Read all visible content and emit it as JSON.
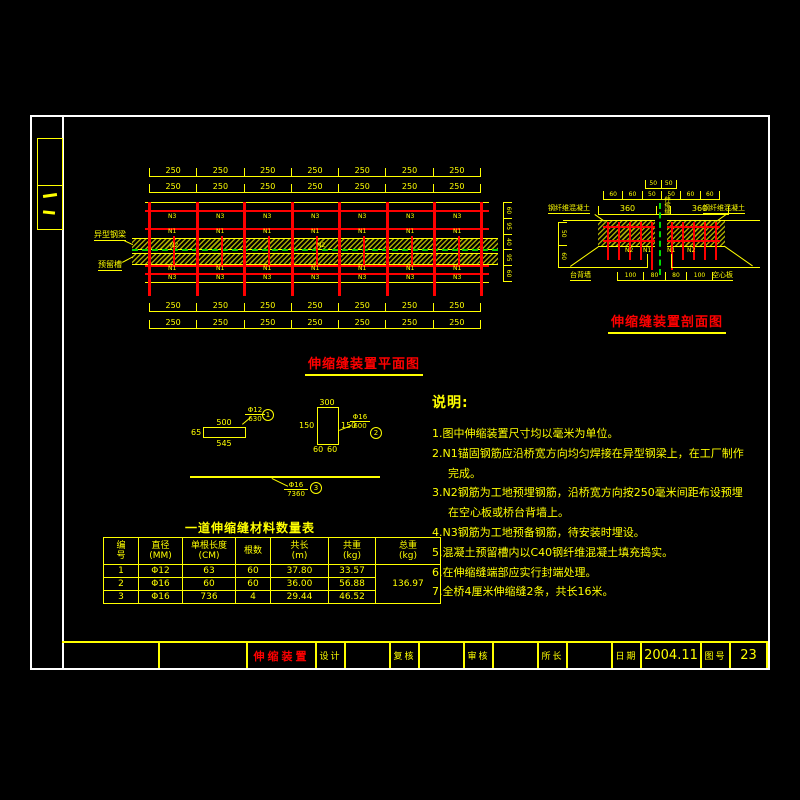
{
  "plan": {
    "title": "伸缩缝装置平面图",
    "top_dims1": [
      "250",
      "250",
      "250",
      "250",
      "250",
      "250",
      "250"
    ],
    "top_dims2": [
      "250",
      "250",
      "250",
      "250",
      "250",
      "250",
      "250"
    ],
    "bottom_dims1": [
      "250",
      "250",
      "250",
      "250",
      "250",
      "250",
      "250"
    ],
    "bottom_dims2": [
      "250",
      "250",
      "250",
      "250",
      "250",
      "250",
      "250"
    ],
    "right_dims": [
      "60",
      "95",
      "40",
      "95",
      "60"
    ],
    "label_beam": "异型钢梁",
    "label_slot": "预留槽",
    "tag_n1": "N1",
    "tag_n2": "N2",
    "tag_n3": "N3"
  },
  "section": {
    "title": "伸缩缝装置剖面图",
    "gap_dims": [
      "50",
      "50"
    ],
    "top_dims": [
      "60",
      "60",
      "50",
      "50",
      "60",
      "60"
    ],
    "span_dims": [
      "360",
      "",
      "360"
    ],
    "bottom_dims": [
      "100",
      "80",
      "80",
      "100"
    ],
    "left_dims": [
      "50",
      "60"
    ],
    "rebar_labels": [
      "N2",
      "N1",
      "N1",
      "N2"
    ],
    "label_left": "钢纤维混凝土",
    "label_right": "钢纤维混凝土",
    "label_joint": "伸缩缝",
    "label_abutment": "台背墙",
    "label_slab": "空心板"
  },
  "details": {
    "d1": {
      "dim_top": "500",
      "dim_left": "65",
      "dim_bottom": "545",
      "bar": "Φ12",
      "len": "630",
      "tag": "1"
    },
    "d2": {
      "dim_top": "300",
      "dim_left": "150",
      "dim_right": "150",
      "dim_b1": "60",
      "dim_b2": "60",
      "bar": "Φ16",
      "len": "600",
      "tag": "2"
    },
    "d3": {
      "bar": "Φ16",
      "len": "7360",
      "tag": "3"
    }
  },
  "notes": {
    "title": "说明:",
    "items": [
      "1.图中伸缩装置尺寸均以毫米为单位。",
      "2.N1锚固钢筋应沿桥宽方向均匀焊接在异型钢梁上，在工厂制作完成。",
      "3.N2钢筋为工地预埋钢筋，沿桥宽方向按250毫米间距布设预埋在空心板或桥台背墙上。",
      "4.N3钢筋为工地预备钢筋，待安装时埋设。",
      "5.混凝土预留槽内以C40钢纤维混凝土填充捣实。",
      "6.在伸缩缝端部应实行封端处理。",
      "7.全桥4厘米伸缩缝2条，共长16米。"
    ]
  },
  "table": {
    "title": "一道伸缩缝材料数量表",
    "headers": [
      [
        "编",
        "号"
      ],
      [
        "直径",
        "(MM)"
      ],
      [
        "单根长度",
        "(CM)"
      ],
      [
        "根数",
        ""
      ],
      [
        "共长",
        "(m)"
      ],
      [
        "共重",
        "(kg)"
      ],
      [
        "总重",
        "(kg)"
      ]
    ],
    "rows": [
      [
        "1",
        "Φ12",
        "63",
        "60",
        "37.80",
        "33.57"
      ],
      [
        "2",
        "Φ16",
        "60",
        "60",
        "36.00",
        "56.88"
      ],
      [
        "3",
        "Φ16",
        "736",
        "4",
        "29.44",
        "46.52"
      ]
    ],
    "total": "136.97"
  },
  "titlebar": {
    "drawing_name": "伸缩装置",
    "design": "设计",
    "check": "复核",
    "review": "审核",
    "director": "所长",
    "date_label": "日期",
    "date_value": "2004.11",
    "sheet_label": "图号",
    "sheet_value": "23"
  }
}
